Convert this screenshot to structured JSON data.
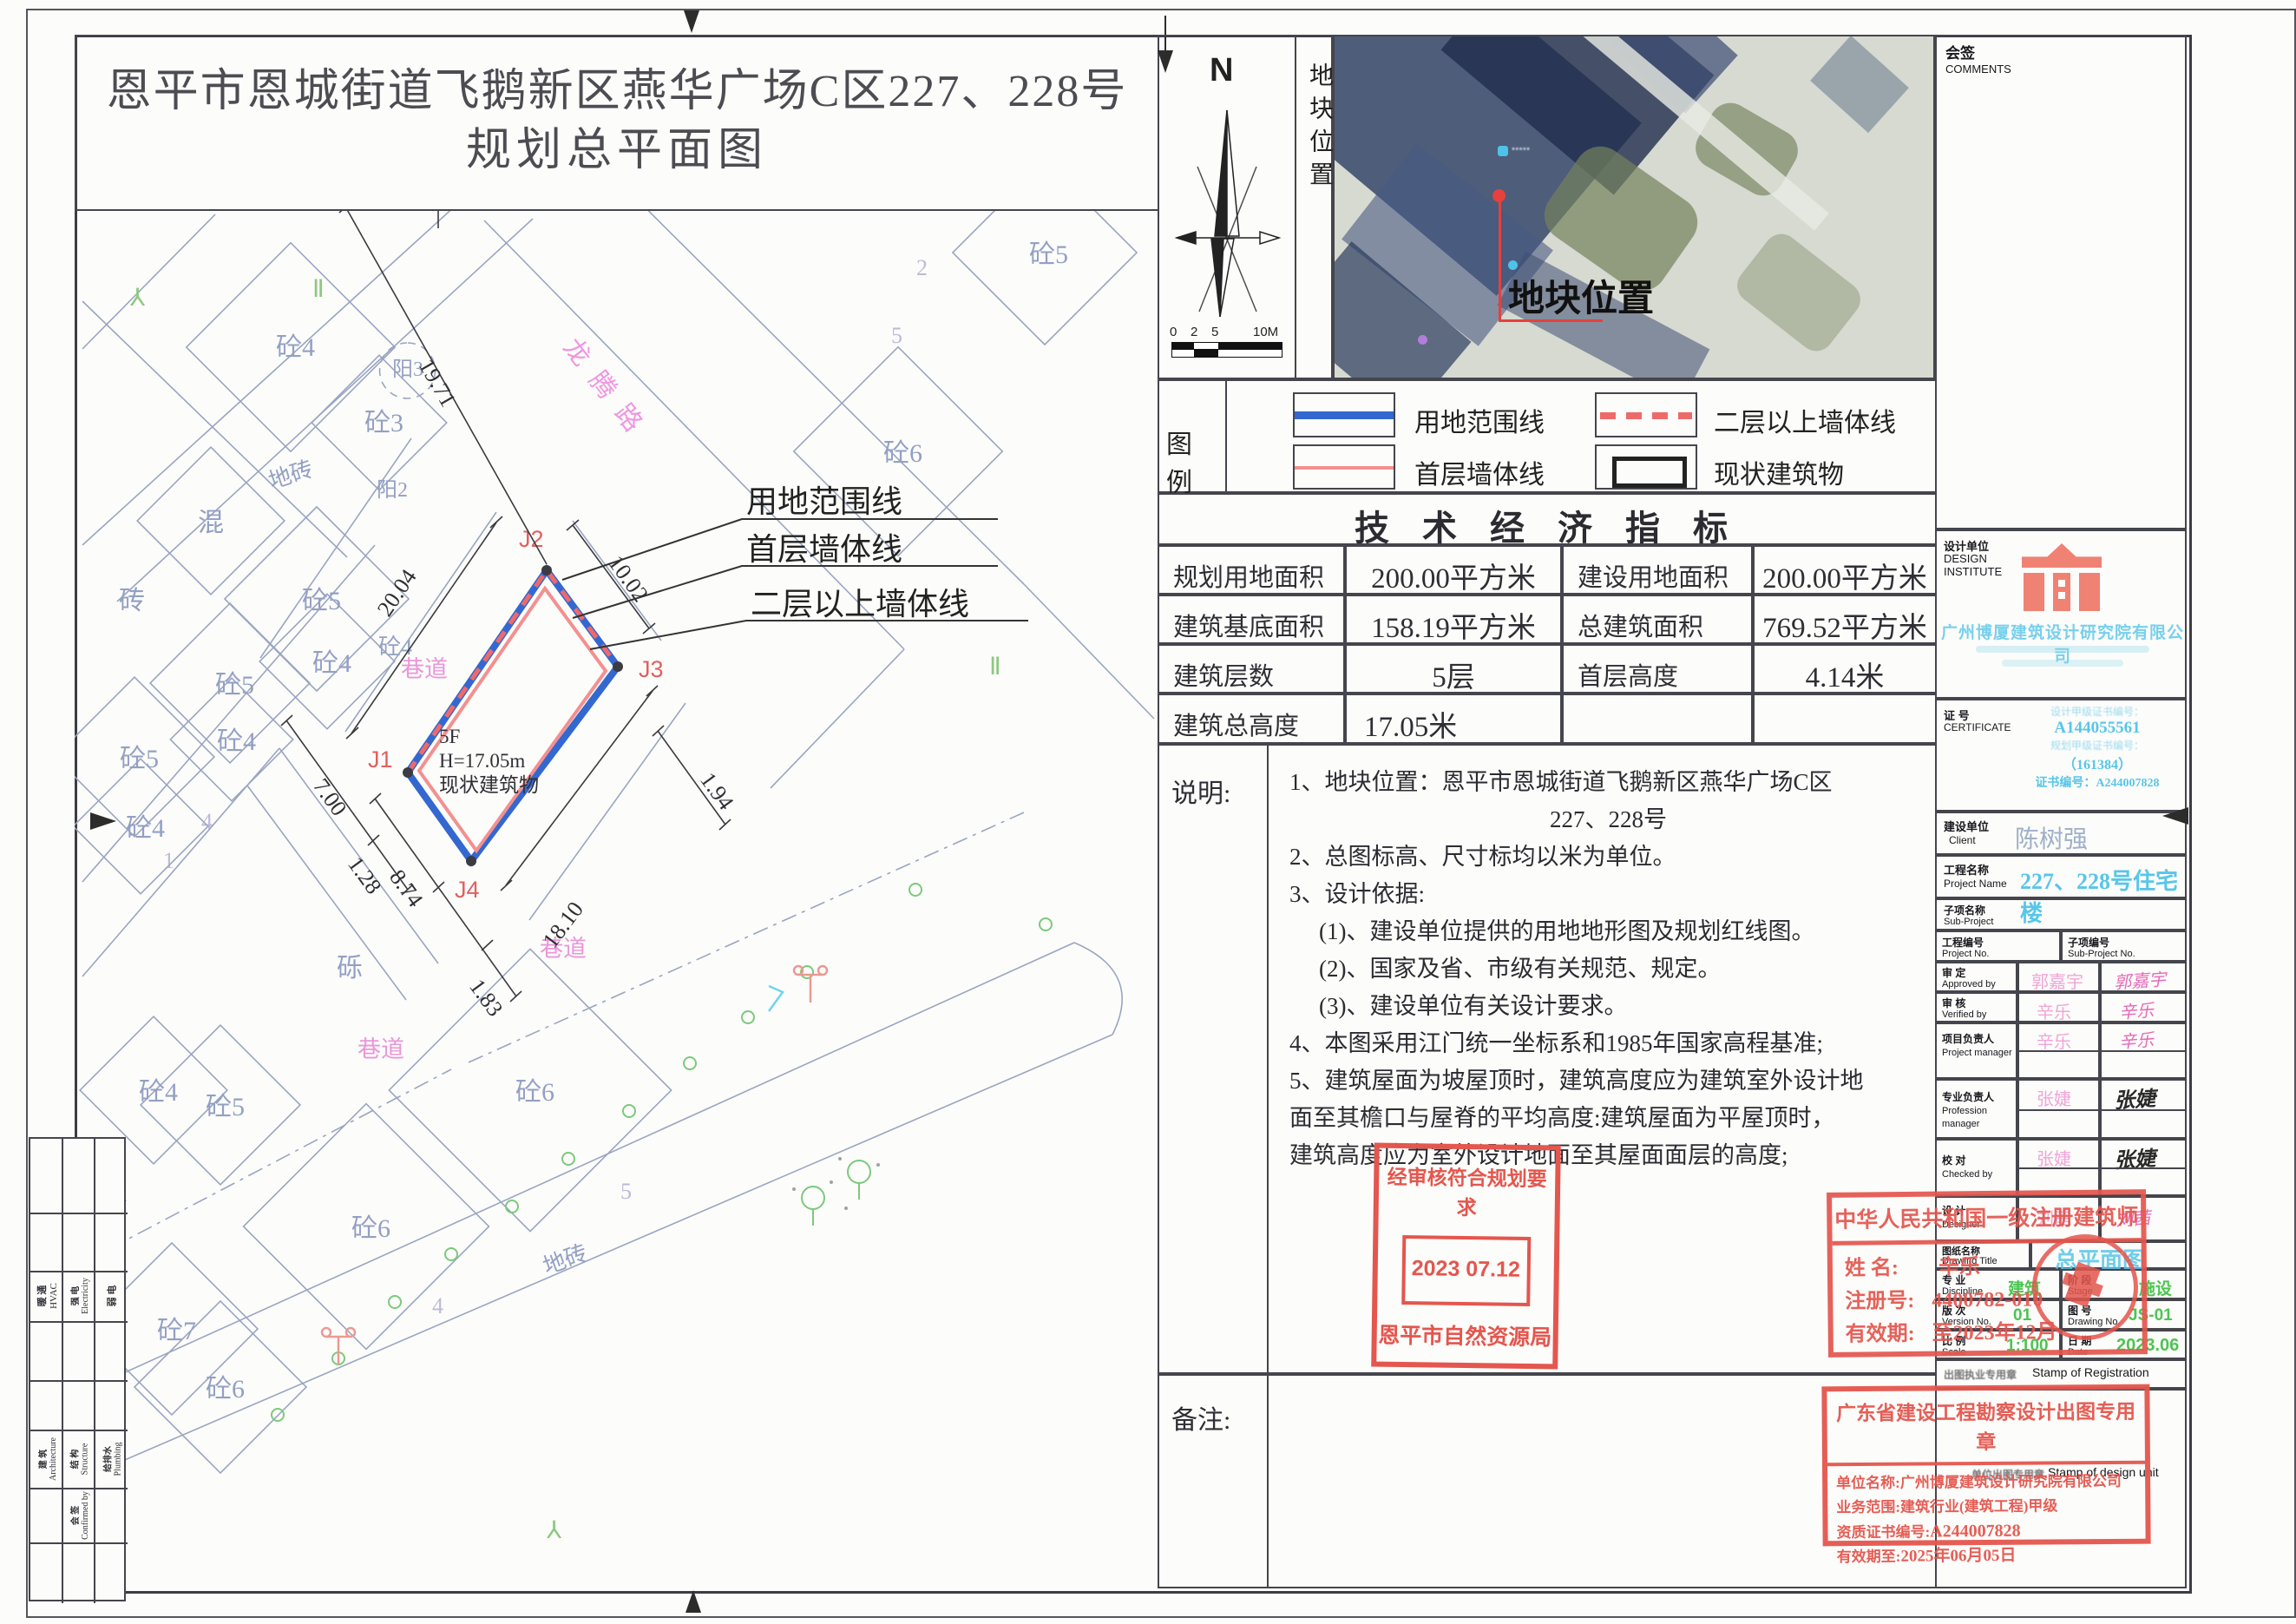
{
  "page": {
    "title_line1": "恩平市恩城街道飞鹅新区燕华广场C区227、228号",
    "title_line2": "规划总平面图"
  },
  "compass": {
    "n": "N",
    "scale": [
      "0",
      "2",
      "5",
      "10M"
    ]
  },
  "location": {
    "side_label": "地块位置",
    "photo_label": "地块位置"
  },
  "legend": {
    "label": "图 例",
    "items": [
      "用地范围线",
      "二层以上墙体线",
      "首层墙体线",
      "现状建筑物"
    ]
  },
  "indicators": {
    "title": "技 术 经 济 指 标",
    "rows": [
      [
        "规划用地面积",
        "200.00平方米",
        "建设用地面积",
        "200.00平方米"
      ],
      [
        "建筑基底面积",
        "158.19平方米",
        "总建筑面积",
        "769.52平方米"
      ],
      [
        "建筑层数",
        "5层",
        "首层高度",
        "4.14米"
      ],
      [
        "建筑总高度",
        "17.05米",
        "",
        ""
      ]
    ]
  },
  "notes": {
    "label": "说明:",
    "lines": [
      "1、地块位置：恩平市恩城街道飞鹅新区燕华广场C区",
      "227、228号",
      "2、总图标高、尺寸标均以米为单位。",
      "3、设计依据:",
      "(1)、建设单位提供的用地地形图及规划红线图。",
      "(2)、国家及省、市级有关规范、规定。",
      "(3)、建设单位有关设计要求。",
      "4、本图采用江门统一坐标系和1985年国家高程基准;",
      "5、建筑屋面为坡屋顶时，建筑高度应为建筑室外设计地",
      "面至其檐口与屋脊的平均高度:建筑屋面为平屋顶时，",
      "建筑高度应为室外设计地面至其屋面面层的高度;"
    ]
  },
  "remarks": {
    "label": "备注:"
  },
  "sidebar": {
    "comments_zh": "会签",
    "comments_en": "COMMENTS",
    "design_zh": "设计单位",
    "design_en": "DESIGN INSTITUTE",
    "company": "广州博厦建筑设计研究院有限公司",
    "cert_zh": "证 号",
    "cert_en": "CERTIFICATE",
    "cert_lines": [
      "设计甲级证书编号：",
      "A144055561",
      "规划甲级证书编号：",
      "（161384）",
      "证书编号：A244007828"
    ],
    "client_zh": "建设单位",
    "client_en": "Client",
    "client": "陈树强",
    "project_zh": "工程名称",
    "project_en": "Project Name",
    "project": "227、228号住宅楼",
    "sub_zh": "子项名称",
    "sub_en": "Sub-Project",
    "pno_zh": "工程编号",
    "pno_en": "Project No.",
    "spno_zh": "子项编号",
    "spno_en": "Sub-Project No.",
    "rows": [
      {
        "zh": "审 定",
        "en": "Approved by",
        "name": "郭嘉宇",
        "sig": "郭嘉宇"
      },
      {
        "zh": "审 核",
        "en": "Verified by",
        "name": "辛乐",
        "sig": "辛乐"
      },
      {
        "zh": "项目负责人",
        "en": "Project manager",
        "name": "辛乐",
        "sig": "辛乐"
      },
      {
        "zh": "专业负责人",
        "en": "Profession manager",
        "name": "张婕",
        "sig": "张婕"
      },
      {
        "zh": "校 对",
        "en": "Checked by",
        "name": "张婕",
        "sig": "张婕"
      },
      {
        "zh": "设 计",
        "en": "Designer",
        "name": "刘茜",
        "sig": "刘茜"
      }
    ],
    "dt_zh": "图纸名称",
    "dt_en": "Drawing Title",
    "dt_value": "总平面图",
    "disc_zh": "专 业",
    "disc_en": "Discipline",
    "disc_value": "建筑",
    "stage_zh": "阶 段",
    "stage_en": "Stage",
    "stage_value": "施设",
    "ver_zh": "版 次",
    "ver_en": "Version No.",
    "ver_value": "01",
    "dno_zh": "图 号",
    "dno_en": "Drawing No.",
    "dno_value": "JS-01",
    "scale_zh": "比 例",
    "scale_en": "Scale",
    "scale_value": "1:100",
    "date_zh": "日 期",
    "date_en": "Date",
    "date_value": "2023.06",
    "reg_zh": "出图执业专用章",
    "reg_en": "Stamp of Registration",
    "unit_zh": "单位出图专用章",
    "unit_en": "Stamp of design unit"
  },
  "stamps": {
    "planning": {
      "line1": "经审核符合规划要求",
      "date": "2023 07.12",
      "line2": "恩平市自然资源局"
    },
    "architect": {
      "title": "中华人民共和国一级注册建筑师",
      "name_label": "姓  名:",
      "name": "辛乐",
      "reg_label": "注册号:",
      "reg_no": "4400782-010",
      "valid_label": "有效期:",
      "valid": "至2023年12月"
    },
    "unit": {
      "title": "广东省建设工程勘察设计出图专用章",
      "r1l": "单位名称:",
      "r1v": "广州博厦建筑设计研究院有限公司",
      "r2l": "业务范围:",
      "r2v": "建筑行业(建筑工程)甲级",
      "r3l": "资质证书编号:",
      "r3v": "A244007828",
      "r4l": "有效期至:",
      "r4v": "2025年06月05日"
    }
  },
  "signoff": {
    "c1zh": "暖 通",
    "c1en": "HVAC",
    "c2zh": "强 电",
    "c2en": "Electricity",
    "c3zh": "弱 电",
    "c3en": "",
    "c4zh": "建 筑",
    "c4en": "Architecture",
    "c5zh": "结 构",
    "c5en": "Structure",
    "c6zh": "给排水",
    "c6en": "Plumbing",
    "c7zh": "会 签",
    "c7en": "Confirmed by"
  },
  "plan": {
    "building": {
      "l1": "5F",
      "l2": "H=17.05m",
      "l3": "现状建筑物"
    },
    "points": [
      "J1",
      "J2",
      "J3",
      "J4"
    ],
    "callouts": [
      "用地范围线",
      "首层墙体线",
      "二层以上墙体线"
    ],
    "roads": [
      "巷道",
      "巷道",
      "巷道",
      "龙腾路"
    ],
    "dims": [
      "20.04",
      "10.02",
      "19.71",
      "18.10",
      "8.74",
      "1.83",
      "1.94",
      "7.00",
      "1.28"
    ],
    "labels": [
      "砼4",
      "砼3",
      "阳3",
      "阳2",
      "混",
      "砖",
      "地砖",
      "砼5",
      "砼6",
      "砼5",
      "砼4",
      "砼4",
      "砼5",
      "砼4",
      "砼5",
      "砼4",
      "砼4",
      "砼5",
      "砼6",
      "砼6",
      "砼7",
      "砼6",
      "地砖",
      "砾",
      "2",
      "5",
      "2",
      "5",
      "4",
      "4",
      "1",
      "Ⅱ",
      "Ⅱ"
    ]
  }
}
